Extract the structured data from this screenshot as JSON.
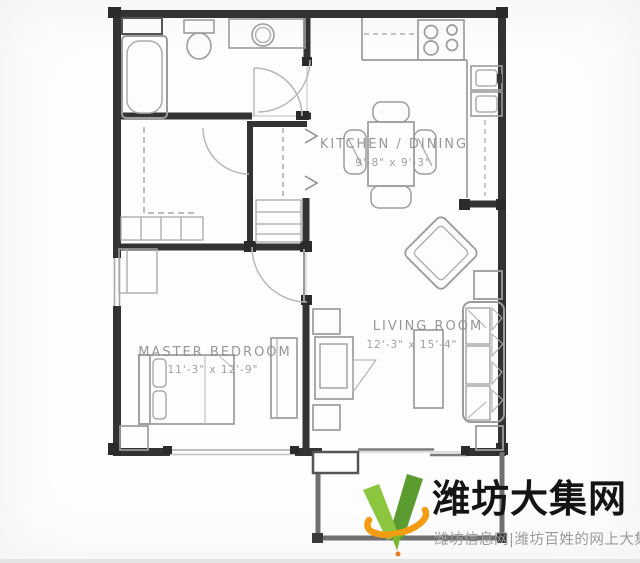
{
  "floor_plan": {
    "labels": {
      "kitchen": {
        "name": "KITCHEN / DINING",
        "dims": "9'-8\" x 9'-3\""
      },
      "living": {
        "name": "LIVING ROOM",
        "dims": "12'-3\" x 15'-4\""
      },
      "bedroom": {
        "name": "MASTER BEDROOM",
        "dims": "11'-3\" x 12'-9\""
      }
    },
    "colors": {
      "wall": "#333333",
      "furniture_line": "#a3a3a3",
      "label_text": "#8f8f8f"
    }
  },
  "watermark": {
    "site_name": "潍坊大集网",
    "tagline": "潍坊信息网|潍坊百姓的网上大集",
    "colors": {
      "title": "#141414",
      "tagline": "#9a9a9a",
      "green_light": "#8cc63f",
      "green_dark": "#5a9c2f",
      "orange": "#f39c12"
    }
  }
}
